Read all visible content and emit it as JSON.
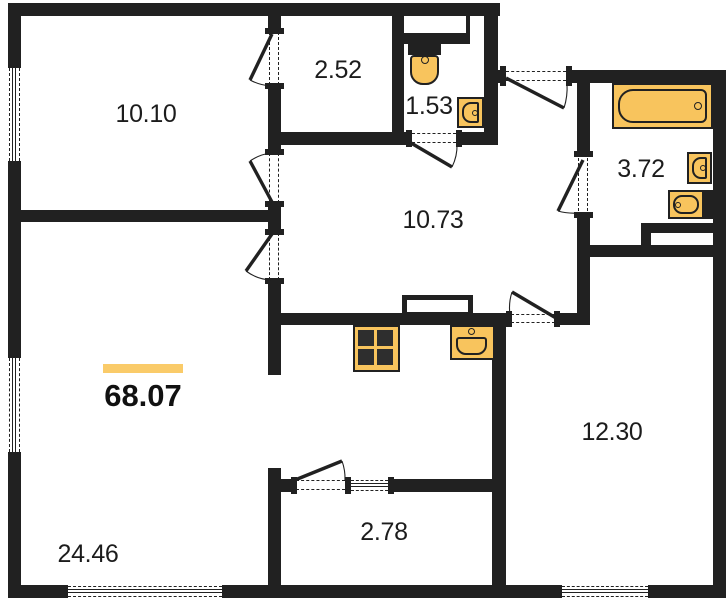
{
  "colors": {
    "wall": "#212121",
    "fixture": "#F8C45D",
    "accent_bar": "#FACB69",
    "text": "#1c1c1c",
    "background": "#ffffff"
  },
  "rooms": [
    {
      "id": "bedroom",
      "area": "10.10"
    },
    {
      "id": "wardrobe",
      "area": "2.52"
    },
    {
      "id": "wc",
      "area": "1.53"
    },
    {
      "id": "hallway",
      "area": "10.73"
    },
    {
      "id": "bathroom",
      "area": "3.72"
    },
    {
      "id": "bedroom-2",
      "area": "12.30"
    },
    {
      "id": "living-kitchen",
      "area": "24.46"
    },
    {
      "id": "balcony",
      "area": "2.78"
    }
  ],
  "total": {
    "area": "68.07"
  },
  "fixtures": [
    {
      "name": "bathtub"
    },
    {
      "name": "bath-sink"
    },
    {
      "name": "bidet-sink"
    },
    {
      "name": "toilet"
    },
    {
      "name": "wc-sink"
    },
    {
      "name": "stove"
    },
    {
      "name": "kitchen-sink"
    },
    {
      "name": "vent-shaft"
    }
  ],
  "plan": {
    "walls": [
      {
        "x": 8,
        "y": 3,
        "w": 13,
        "h": 595
      },
      {
        "x": 8,
        "y": 3,
        "w": 492,
        "h": 13
      },
      {
        "x": 8,
        "y": 585,
        "w": 718,
        "h": 13
      },
      {
        "x": 713,
        "y": 70,
        "w": 13,
        "h": 528
      },
      {
        "x": 490,
        "y": 70,
        "w": 15,
        "h": 13
      },
      {
        "x": 569,
        "y": 70,
        "w": 157,
        "h": 13
      },
      {
        "x": 484,
        "y": 3,
        "w": 14,
        "h": 142
      },
      {
        "x": 268,
        "y": 3,
        "w": 13,
        "h": 29
      },
      {
        "x": 268,
        "y": 85,
        "w": 13,
        "h": 68
      },
      {
        "x": 268,
        "y": 203,
        "w": 13,
        "h": 30
      },
      {
        "x": 268,
        "y": 280,
        "w": 13,
        "h": 95
      },
      {
        "x": 8,
        "y": 210,
        "w": 273,
        "h": 12
      },
      {
        "x": 392,
        "y": 3,
        "w": 12,
        "h": 142
      },
      {
        "x": 268,
        "y": 132,
        "w": 142,
        "h": 13
      },
      {
        "x": 458,
        "y": 132,
        "w": 38,
        "h": 13
      },
      {
        "x": 281,
        "y": 313,
        "w": 227,
        "h": 12
      },
      {
        "x": 557,
        "y": 313,
        "w": 31,
        "h": 12
      },
      {
        "x": 577,
        "y": 245,
        "w": 13,
        "h": 80
      },
      {
        "x": 577,
        "y": 70,
        "w": 13,
        "h": 87
      },
      {
        "x": 577,
        "y": 213,
        "w": 13,
        "h": 44
      },
      {
        "x": 577,
        "y": 245,
        "w": 149,
        "h": 12
      },
      {
        "x": 641,
        "y": 223,
        "w": 72,
        "h": 10
      },
      {
        "x": 641,
        "y": 223,
        "w": 10,
        "h": 22
      },
      {
        "x": 268,
        "y": 468,
        "w": 13,
        "h": 130
      },
      {
        "x": 279,
        "y": 479,
        "w": 14,
        "h": 13
      },
      {
        "x": 393,
        "y": 479,
        "w": 113,
        "h": 13
      },
      {
        "x": 492,
        "y": 313,
        "w": 14,
        "h": 285
      },
      {
        "x": 704,
        "y": 190,
        "w": 11,
        "h": 29
      },
      {
        "x": 398,
        "y": 16,
        "w": 72,
        "h": 28
      },
      {
        "n": "white",
        "x": 404,
        "y": 16,
        "w": 62,
        "h": 17
      },
      {
        "n": "white",
        "x": 651,
        "y": 233,
        "w": 62,
        "h": 12
      },
      {
        "n": "cap",
        "x": 265,
        "y": 28,
        "w": 19,
        "h": 6
      },
      {
        "n": "cap",
        "x": 265,
        "y": 83,
        "w": 19,
        "h": 6
      },
      {
        "n": "cap",
        "x": 265,
        "y": 149,
        "w": 19,
        "h": 6
      },
      {
        "n": "cap",
        "x": 265,
        "y": 201,
        "w": 19,
        "h": 6
      },
      {
        "n": "cap",
        "x": 265,
        "y": 229,
        "w": 19,
        "h": 6
      },
      {
        "n": "cap",
        "x": 265,
        "y": 278,
        "w": 19,
        "h": 6
      },
      {
        "n": "cap",
        "x": 406,
        "y": 130,
        "w": 6,
        "h": 17
      },
      {
        "n": "cap",
        "x": 456,
        "y": 130,
        "w": 6,
        "h": 17
      },
      {
        "n": "cap",
        "x": 500,
        "y": 66,
        "w": 6,
        "h": 20
      },
      {
        "n": "cap",
        "x": 566,
        "y": 66,
        "w": 6,
        "h": 20
      },
      {
        "n": "cap",
        "x": 574,
        "y": 151,
        "w": 19,
        "h": 6
      },
      {
        "n": "cap",
        "x": 574,
        "y": 212,
        "w": 19,
        "h": 6
      },
      {
        "n": "cap",
        "x": 506,
        "y": 311,
        "w": 6,
        "h": 16
      },
      {
        "n": "cap",
        "x": 554,
        "y": 311,
        "w": 6,
        "h": 16
      },
      {
        "n": "cap",
        "x": 291,
        "y": 477,
        "w": 6,
        "h": 17
      },
      {
        "n": "cap",
        "x": 345,
        "y": 477,
        "w": 6,
        "h": 17
      },
      {
        "n": "cap",
        "x": 388,
        "y": 477,
        "w": 6,
        "h": 17
      },
      {
        "n": "wincap",
        "x": 8,
        "y": 57,
        "w": 13,
        "h": 11
      },
      {
        "n": "wincap",
        "x": 8,
        "y": 161,
        "w": 13,
        "h": 11
      },
      {
        "n": "wincap",
        "x": 8,
        "y": 347,
        "w": 13,
        "h": 11
      },
      {
        "n": "wincap",
        "x": 8,
        "y": 452,
        "w": 13,
        "h": 11
      },
      {
        "n": "wincap",
        "x": 57,
        "y": 585,
        "w": 11,
        "h": 13
      },
      {
        "n": "wincap",
        "x": 222,
        "y": 585,
        "w": 11,
        "h": 13
      },
      {
        "n": "wincap",
        "x": 552,
        "y": 585,
        "w": 10,
        "h": 13
      },
      {
        "n": "wincap",
        "x": 648,
        "y": 585,
        "w": 10,
        "h": 13
      }
    ],
    "windows": [
      {
        "x": 8,
        "y": 68,
        "len": 93,
        "o": "v",
        "t": 13
      },
      {
        "x": 8,
        "y": 358,
        "len": 94,
        "o": "v",
        "t": 13
      },
      {
        "x": 68,
        "y": 585,
        "len": 154,
        "o": "h",
        "t": 13
      },
      {
        "x": 562,
        "y": 585,
        "len": 86,
        "o": "h",
        "t": 13
      },
      {
        "x": 351,
        "y": 479,
        "len": 37,
        "o": "h",
        "t": 13
      }
    ],
    "openings": [
      {
        "x": 268,
        "y": 32,
        "len": 53,
        "o": "v",
        "t": 13
      },
      {
        "x": 268,
        "y": 153,
        "len": 50,
        "o": "v",
        "t": 13
      },
      {
        "x": 268,
        "y": 233,
        "len": 47,
        "o": "v",
        "t": 13
      },
      {
        "x": 412,
        "y": 132,
        "len": 44,
        "o": "h",
        "t": 13
      },
      {
        "x": 506,
        "y": 70,
        "len": 60,
        "o": "h",
        "t": 13
      },
      {
        "x": 577,
        "y": 158,
        "len": 53,
        "o": "v",
        "t": 13
      },
      {
        "x": 511,
        "y": 313,
        "len": 44,
        "o": "h",
        "t": 12
      },
      {
        "x": 296,
        "y": 479,
        "len": 49,
        "o": "h",
        "t": 13
      }
    ],
    "doors": [
      {
        "h": [
          272,
          34
        ],
        "e": [
          250,
          80
        ],
        "b": [
          271,
          86
        ]
      },
      {
        "h": [
          272,
          202
        ],
        "e": [
          250,
          161
        ],
        "b": [
          271,
          153
        ]
      },
      {
        "h": [
          272,
          234
        ],
        "e": [
          246,
          271
        ],
        "b": [
          271,
          280
        ]
      },
      {
        "h": [
          411,
          143
        ],
        "e": [
          452,
          167
        ],
        "b": [
          457,
          144
        ]
      },
      {
        "h": [
          506,
          78
        ],
        "e": [
          564,
          108
        ],
        "b": [
          567,
          84
        ]
      },
      {
        "h": [
          583,
          160
        ],
        "e": [
          558,
          211
        ],
        "b": [
          578,
          213
        ]
      },
      {
        "h": [
          556,
          318
        ],
        "e": [
          512,
          292
        ],
        "b": [
          510,
          315
        ]
      },
      {
        "h": [
          295,
          480
        ],
        "e": [
          342,
          461
        ],
        "b": [
          345,
          480
        ]
      }
    ]
  }
}
